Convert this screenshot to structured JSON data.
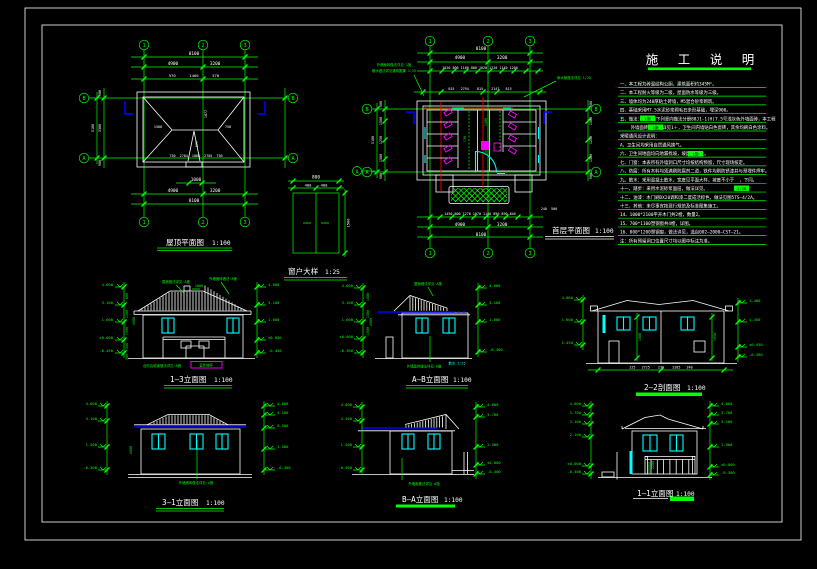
{
  "colors": {
    "background": "#000000",
    "line_green": "#00ff00",
    "line_white": "#ffffff",
    "window_cyan": "#00ffff",
    "section_red": "#ff0000",
    "fixture_magenta": "#ff00ff",
    "eave_blue": "#0000ff"
  },
  "axes": {
    "cols": [
      "1",
      "2",
      "3"
    ],
    "row_top": "B",
    "row_bottom": "A"
  },
  "notes": {
    "title": "施 工 说 明",
    "lines": [
      "一、本工程为砖混结构公厕，建筑面积约345M²。",
      "二、本工程耐火等级为二级，屋面防水等级为三级。",
      "三、墙体均为240厚粘土砖墙，M5混合砂浆砌筑。",
      "四、基础采用M7.5水泥砂浆砌毛石条形基础，埋深900。",
      "五、做法：  选自下列竖向做法分册88J1-1(H)7.5号浅灰色外墙面砖，本工程",
      "    外墙面砖分格  详见1＋，卫生间内墙贴白色瓷砖，其余均刷白色涂料。",
      "采暖通风设计说明：",
      "A、卫生间均采用自然通风换气。",
      "六、卫生间地面均向地漏找坡，坡度  以上。",
      "七、门窗：本表所有外墙洞口尺寸均按结构预留，尺寸现场核定。",
      "八、防腐：所有木料均须满刷防腐剂二道，铁件均刷防锈漆并与预埋件焊牢。",
      "九、散水：采用混凝土散水，宽度见平面大样，坡度不小于  ，下同。",
      "十一、踏步：采用水泥砂浆面层，做法详见。",
      "十二、油漆：木门刷DX20调和漆二度成活棕色，做法见图5TS—4/2A。",
      "十三、其他：未尽事宜按现行规范及标准图集施工。",
      "14、1000*2100平开木门共2樘，数量2。",
      "15、700*1100塑钢窗共4樘，详图。",
      "16、800*1200塑钢窗，做法详见，选自002—2000—CST—21。",
      "注：所有预留洞口位置尺寸均以图中标注为准。"
    ],
    "highlights": [
      "1施",
      "3施",
      "2施",
      "1:30"
    ]
  },
  "roof_plan": {
    "title": "屋顶平面图",
    "scale": "1:100",
    "dim_total": "8100",
    "dim_spans": "4900            3200",
    "dim_eaves": "570      1460      570",
    "dim_ridge": "1000",
    "dim_bottom_spans": "4900            3200",
    "dim_bottom_total": "8100",
    "side_dims": [
      "900",
      "3300",
      "900"
    ],
    "side_total": "5100",
    "hip_left": "1500",
    "hip_right": "750",
    "ridge_len": "1877",
    "gablet": "977",
    "inner_row": "750  2784  1068  2705  750"
  },
  "floor_plan": {
    "title": "首层平面图",
    "scale": "1:100",
    "dim_total": "8100",
    "dim_spans": "4900            3200",
    "dim_openings": "1020 800 1160 800 1020 1220 1140 1200",
    "dim_inner": "815   2794    815    2147   815",
    "dim_bottom_openings": "1450 800 1270 1070 1140 890 890 840",
    "dim_bottom_small": "240  500",
    "dim_bottom_spans": "4900            3200",
    "dim_bottom_total": "8100",
    "side_dims": [
      "900",
      "1500",
      "1250",
      "1500",
      "900"
    ],
    "side_total": "5100",
    "note_left1": "外墙面砖做法详见·1施",
    "note_left2": "散水做法详见通用图集 1:25",
    "note_right": "雨水管做法详见 1/25",
    "room_dims": [
      "1400",
      "900",
      "130"
    ]
  },
  "window_detail": {
    "title": "窗户大样",
    "scale": "1:25",
    "dim_width": "800",
    "dim_halves": "400    400",
    "dim_height": "1500",
    "mark": "A"
  },
  "elev_13": {
    "title": "1—3立面图",
    "scale": "1:100",
    "levels_left": [
      "4.600",
      "3.100",
      "1.600",
      "±0.000",
      "-0.450"
    ],
    "levels_right": [
      "4.600",
      "3.100",
      "1.600",
      "±0.000",
      "-0.450"
    ],
    "vdims": [
      "600",
      "1500",
      "1900",
      "1500"
    ],
    "vtotal": "4900",
    "vbase": "300",
    "ridge_dim": "1000",
    "note_roof": "屋面做法详见·A施",
    "note_wall": "外墙面砖做法·A施",
    "note_step": "台阶及坡道做法详见·A施",
    "note_ground": "室外地坪"
  },
  "elev_ab": {
    "title": "A—B立面图",
    "scale": "1:100",
    "levels_left": [
      "4.600",
      "3.100",
      "1.600",
      "±0.000",
      "-0.300"
    ],
    "levels_right": [
      "4.600",
      "3.100",
      "1.600",
      "-0.300"
    ],
    "vdims": [
      "1500",
      "1500",
      "1900"
    ],
    "vtotal": "4900",
    "note_roof": "屋面做法详见·A施",
    "note_wall": "外墙面砖做法详见·A施",
    "note_step": "散水 1:25"
  },
  "sect_22": {
    "title": "2—2剖面图",
    "scale": "1:100",
    "levels_left": [
      "4.600",
      "1.600",
      "1.450"
    ],
    "levels_right": [
      "1.400",
      "1.450",
      "±0.450",
      "-0.300"
    ],
    "indims": [
      "1900",
      "1950"
    ],
    "dim_bottom": "225   2725    230    2285   240"
  },
  "elev_31": {
    "title": "3—1立面图",
    "scale": "1:100",
    "levels_left": [
      "4.600",
      "3.100",
      "1.500",
      "-0.300"
    ],
    "levels_right": [
      "4.600",
      "4.100",
      "3.100",
      "1.500",
      "-0.300"
    ],
    "vtotal": "4900",
    "note_wall": "外墙面砖做法详见·A施"
  },
  "elev_ba": {
    "title": "B—A立面图",
    "scale": "1:100",
    "levels_left": [
      "4.600",
      "3.100",
      "1.500",
      "-0.300"
    ],
    "levels_right": [
      "4.600",
      "3.700",
      "1.500",
      "±0.000",
      "-0.300"
    ],
    "note_wall": "外墙面做法详见·A施"
  },
  "sect_11": {
    "title": "1—1立面图",
    "scale": "1:100",
    "levels_left": [
      "4.600",
      "3.700",
      "3.100",
      "2.100",
      "±0.000",
      "-0.300"
    ],
    "levels_right": [
      "4.600",
      "3.700",
      "3.100",
      "1.900",
      "±0.000",
      "-0.300"
    ],
    "indim": "2200"
  }
}
